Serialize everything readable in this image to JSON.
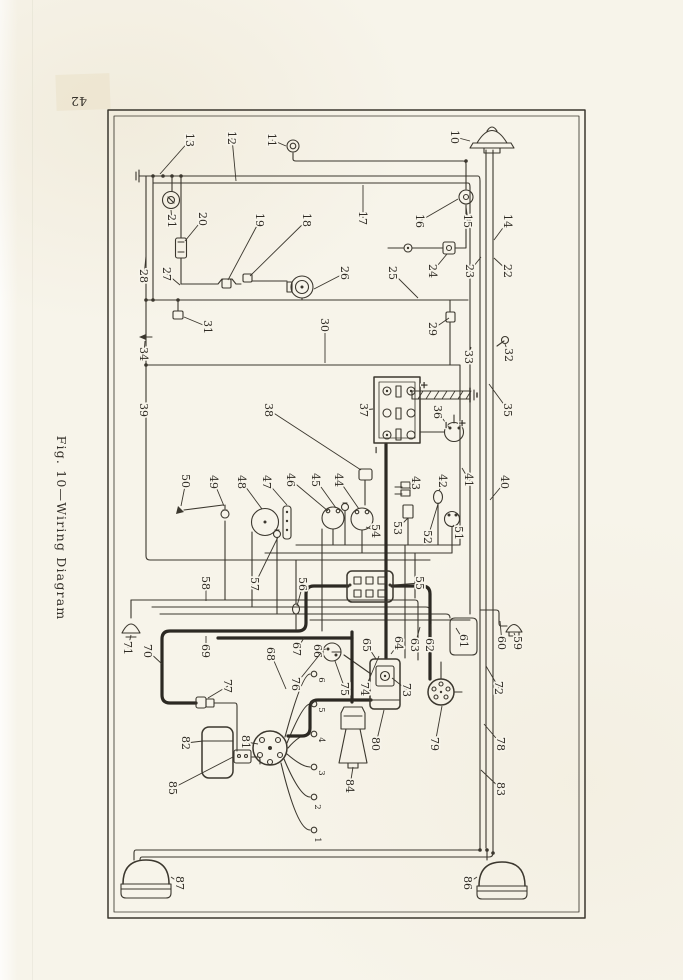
{
  "page": {
    "number": "42",
    "caption": "Fig. 10—Wiring Diagram"
  },
  "diagram": {
    "paper_color": "#f7f4ea",
    "ink_color": "#3b372e",
    "callouts": [
      {
        "n": "10",
        "x": 455,
        "y": 137,
        "tx": 470,
        "ty": 141
      },
      {
        "n": "11",
        "x": 272,
        "y": 140,
        "tx": 286,
        "ty": 146
      },
      {
        "n": "12",
        "x": 232,
        "y": 138,
        "tx": 236,
        "ty": 181
      },
      {
        "n": "13",
        "x": 190,
        "y": 140,
        "tx": 160,
        "ty": 174
      },
      {
        "n": "14",
        "x": 508,
        "y": 221,
        "tx": 494,
        "ty": 240
      },
      {
        "n": "15",
        "x": 468,
        "y": 221,
        "tx": 466,
        "ty": 207
      },
      {
        "n": "16",
        "x": 420,
        "y": 221,
        "tx": 458,
        "ty": 199
      },
      {
        "n": "17",
        "x": 363,
        "y": 218,
        "tx": 363,
        "ty": 185
      },
      {
        "n": "18",
        "x": 307,
        "y": 220,
        "tx": 250,
        "ty": 276
      },
      {
        "n": "19",
        "x": 260,
        "y": 220,
        "tx": 228,
        "ty": 280
      },
      {
        "n": "20",
        "x": 203,
        "y": 219,
        "tx": 185,
        "ty": 241
      },
      {
        "n": "21",
        "x": 172,
        "y": 221,
        "tx": 171,
        "ty": 210
      },
      {
        "n": "22",
        "x": 508,
        "y": 271,
        "tx": 494,
        "ty": 258
      },
      {
        "n": "23",
        "x": 470,
        "y": 271,
        "tx": 481,
        "ty": 257
      },
      {
        "n": "24",
        "x": 433,
        "y": 271,
        "tx": 447,
        "ty": 254
      },
      {
        "n": "25",
        "x": 393,
        "y": 273,
        "tx": 418,
        "ty": 298
      },
      {
        "n": "26",
        "x": 345,
        "y": 273,
        "tx": 314,
        "ty": 289
      },
      {
        "n": "27",
        "x": 167,
        "y": 274,
        "tx": 180,
        "ty": 285
      },
      {
        "n": "28",
        "x": 144,
        "y": 276,
        "tx": 146,
        "ty": 256
      },
      {
        "n": "29",
        "x": 433,
        "y": 329,
        "tx": 449,
        "ty": 318
      },
      {
        "n": "30",
        "x": 325,
        "y": 325,
        "tx": 325,
        "ty": 363
      },
      {
        "n": "31",
        "x": 208,
        "y": 327,
        "tx": 184,
        "ty": 317
      },
      {
        "n": "32",
        "x": 509,
        "y": 355,
        "tx": 505,
        "ty": 344
      },
      {
        "n": "33",
        "x": 469,
        "y": 357,
        "tx": 471,
        "ty": 347
      },
      {
        "n": "34",
        "x": 144,
        "y": 354,
        "tx": 145,
        "ty": 341
      },
      {
        "n": "35",
        "x": 508,
        "y": 410,
        "tx": 489,
        "ty": 384
      },
      {
        "n": "36",
        "x": 438,
        "y": 412,
        "tx": 450,
        "ty": 429
      },
      {
        "n": "37",
        "x": 364,
        "y": 410,
        "tx": 373,
        "ty": 409
      },
      {
        "n": "38",
        "x": 269,
        "y": 410,
        "tx": 361,
        "ty": 470
      },
      {
        "n": "39",
        "x": 144,
        "y": 410,
        "tx": 148,
        "ty": 416
      },
      {
        "n": "40",
        "x": 505,
        "y": 482,
        "tx": 490,
        "ty": 500
      },
      {
        "n": "41",
        "x": 469,
        "y": 480,
        "tx": 462,
        "ty": 468
      },
      {
        "n": "42",
        "x": 443,
        "y": 481,
        "tx": 439,
        "ty": 491
      },
      {
        "n": "43",
        "x": 416,
        "y": 483,
        "tx": 410,
        "ty": 489
      },
      {
        "n": "44",
        "x": 339,
        "y": 480,
        "tx": 359,
        "ty": 509
      },
      {
        "n": "45",
        "x": 316,
        "y": 480,
        "tx": 336,
        "ty": 508
      },
      {
        "n": "46",
        "x": 291,
        "y": 480,
        "tx": 328,
        "ty": 511
      },
      {
        "n": "47",
        "x": 267,
        "y": 482,
        "tx": 287,
        "ty": 505
      },
      {
        "n": "48",
        "x": 242,
        "y": 482,
        "tx": 262,
        "ty": 509
      },
      {
        "n": "49",
        "x": 214,
        "y": 482,
        "tx": 224,
        "ty": 506
      },
      {
        "n": "50",
        "x": 186,
        "y": 481,
        "tx": 181,
        "ty": 506
      },
      {
        "n": "51",
        "x": 459,
        "y": 533,
        "tx": 453,
        "ty": 525
      },
      {
        "n": "52",
        "x": 428,
        "y": 537,
        "tx": 438,
        "ty": 504
      },
      {
        "n": "53",
        "x": 398,
        "y": 528,
        "tx": 408,
        "ty": 518
      },
      {
        "n": "54",
        "x": 376,
        "y": 531,
        "tx": 366,
        "ty": 527
      },
      {
        "n": "55",
        "x": 420,
        "y": 583,
        "tx": 394,
        "ty": 585
      },
      {
        "n": "56",
        "x": 303,
        "y": 584,
        "tx": 297,
        "ty": 606
      },
      {
        "n": "57",
        "x": 255,
        "y": 584,
        "tx": 278,
        "ty": 537
      },
      {
        "n": "58",
        "x": 206,
        "y": 583,
        "tx": 206,
        "ty": 601
      },
      {
        "n": "59",
        "x": 518,
        "y": 643,
        "tx": 514,
        "ty": 633
      },
      {
        "n": "60",
        "x": 502,
        "y": 643,
        "tx": 500,
        "ty": 621
      },
      {
        "n": "61",
        "x": 464,
        "y": 641,
        "tx": 456,
        "ty": 628
      },
      {
        "n": "62",
        "x": 430,
        "y": 645,
        "tx": 431,
        "ty": 624
      },
      {
        "n": "63",
        "x": 415,
        "y": 645,
        "tx": 420,
        "ty": 627
      },
      {
        "n": "64",
        "x": 399,
        "y": 643,
        "tx": 391,
        "ty": 654
      },
      {
        "n": "65",
        "x": 367,
        "y": 645,
        "tx": 376,
        "ty": 659
      },
      {
        "n": "66",
        "x": 318,
        "y": 651,
        "tx": 326,
        "ty": 649
      },
      {
        "n": "67",
        "x": 297,
        "y": 649,
        "tx": 304,
        "ty": 638
      },
      {
        "n": "68",
        "x": 271,
        "y": 654,
        "tx": 286,
        "ty": 689
      },
      {
        "n": "69",
        "x": 206,
        "y": 651,
        "tx": 206,
        "ty": 636
      },
      {
        "n": "70",
        "x": 148,
        "y": 651,
        "tx": 162,
        "ty": 664
      },
      {
        "n": "71",
        "x": 128,
        "y": 648,
        "tx": 131,
        "ty": 635
      },
      {
        "n": "72",
        "x": 499,
        "y": 688,
        "tx": 486,
        "ty": 666
      },
      {
        "n": "73",
        "x": 407,
        "y": 690,
        "tx": 392,
        "ty": 678
      },
      {
        "n": "74",
        "x": 365,
        "y": 689,
        "tx": 379,
        "ty": 656
      },
      {
        "n": "75",
        "x": 345,
        "y": 689,
        "tx": 335,
        "ty": 661
      },
      {
        "n": "76",
        "x": 296,
        "y": 684,
        "tx": 321,
        "ty": 653
      },
      {
        "n": "77",
        "x": 228,
        "y": 686,
        "tx": 208,
        "ty": 698
      },
      {
        "n": "78",
        "x": 501,
        "y": 744,
        "tx": 484,
        "ty": 724
      },
      {
        "n": "79",
        "x": 435,
        "y": 744,
        "tx": 442,
        "ty": 706
      },
      {
        "n": "80",
        "x": 376,
        "y": 744,
        "tx": 384,
        "ty": 710
      },
      {
        "n": "81",
        "x": 246,
        "y": 742,
        "tx": 258,
        "ty": 744
      },
      {
        "n": "82",
        "x": 186,
        "y": 743,
        "tx": 203,
        "ty": 741
      },
      {
        "n": "83",
        "x": 501,
        "y": 789,
        "tx": 481,
        "ty": 770
      },
      {
        "n": "84",
        "x": 350,
        "y": 786,
        "tx": 353,
        "ty": 767
      },
      {
        "n": "85",
        "x": 173,
        "y": 788,
        "tx": 233,
        "ty": 757
      },
      {
        "n": "86",
        "x": 468,
        "y": 883,
        "tx": 477,
        "ty": 877
      },
      {
        "n": "87",
        "x": 180,
        "y": 883,
        "tx": 171,
        "ty": 877
      }
    ],
    "terminal_labels": [
      {
        "n": "6",
        "x": 322,
        "y": 680
      },
      {
        "n": "5",
        "x": 322,
        "y": 710
      },
      {
        "n": "4",
        "x": 322,
        "y": 740
      },
      {
        "n": "3",
        "x": 322,
        "y": 773
      },
      {
        "n": "2",
        "x": 318,
        "y": 807
      },
      {
        "n": "1",
        "x": 318,
        "y": 840
      }
    ],
    "polarity_marks": [
      {
        "t": "+",
        "x": 424,
        "y": 385
      },
      {
        "t": "+",
        "x": 462,
        "y": 423
      },
      {
        "t": "−",
        "x": 446,
        "y": 425
      },
      {
        "t": "−",
        "x": 376,
        "y": 450
      }
    ]
  }
}
